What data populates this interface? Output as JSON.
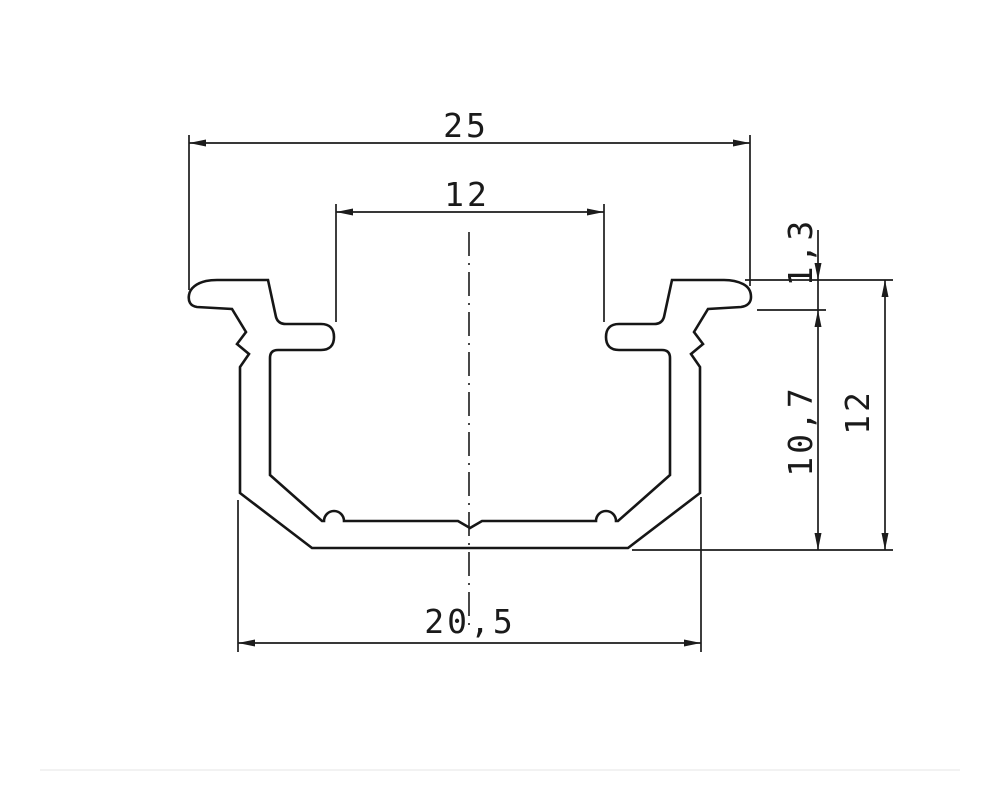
{
  "drawing": {
    "kind": "technical-cross-section-drawing",
    "subject": "extruded-channel-profile",
    "background_color": "#ffffff",
    "line_color": "#1a1a1a",
    "decimal_style": "comma",
    "dimensions": {
      "overall_width": {
        "label": "25",
        "orientation": "horizontal",
        "position": "top"
      },
      "opening_width": {
        "label": "12",
        "orientation": "horizontal",
        "position": "top-inner"
      },
      "flange_thickness": {
        "label": "1,3",
        "orientation": "vertical",
        "position": "right-upper"
      },
      "inner_depth": {
        "label": "10,7",
        "orientation": "vertical",
        "position": "right"
      },
      "overall_height": {
        "label": "12",
        "orientation": "vertical",
        "position": "right-outer"
      },
      "body_width": {
        "label": "20,5",
        "orientation": "horizontal",
        "position": "bottom"
      }
    }
  }
}
